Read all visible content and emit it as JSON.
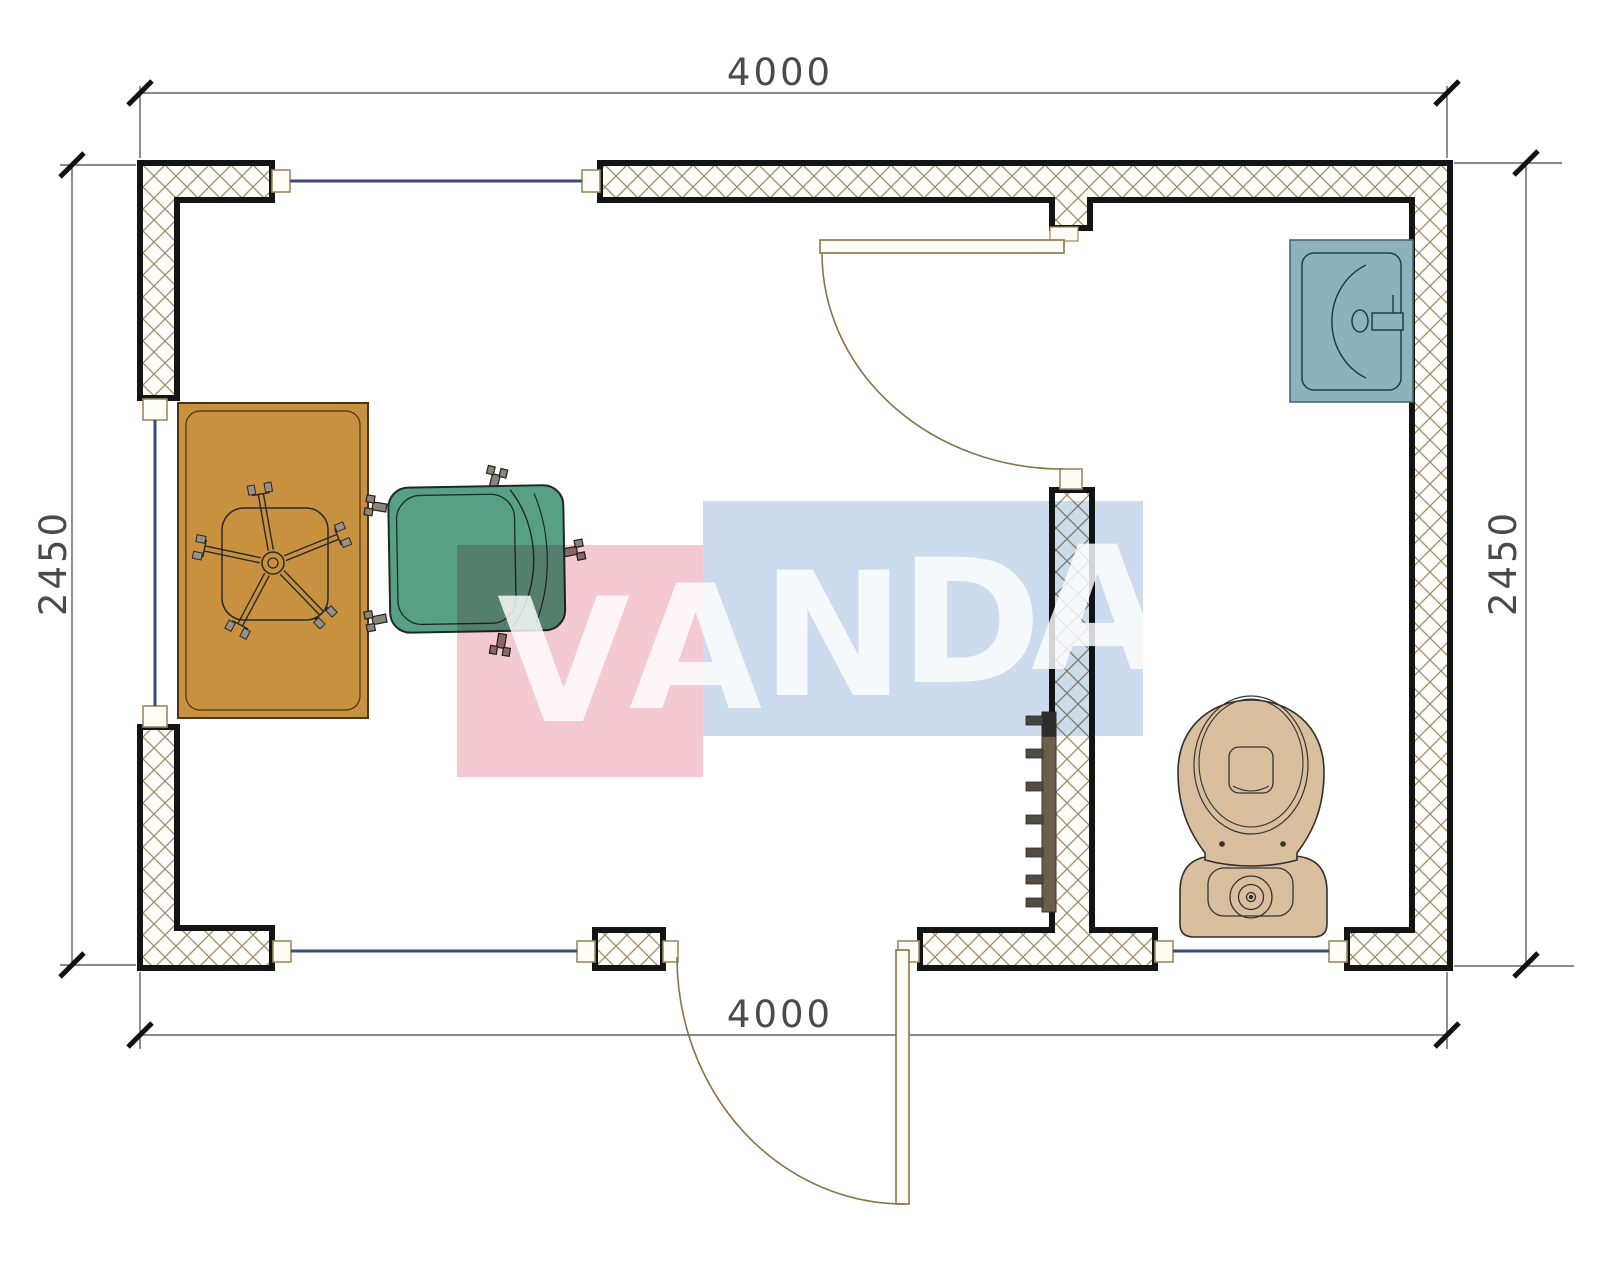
{
  "document": {
    "type": "architectural-floor-plan",
    "view": "top-down plan of portable cabin with office room and bathroom"
  },
  "dimensions": {
    "top": "4000",
    "bottom": "4000",
    "left": "2450",
    "right": "2450"
  },
  "watermark": {
    "text": "VANDA",
    "letters": [
      "V",
      "A",
      "N",
      "D",
      "A"
    ],
    "pink_block": "#f5c9d1",
    "blue_block": "#ccdcee",
    "letter_color": "#ffffff"
  },
  "plan": {
    "rooms": [
      {
        "name": "office",
        "items": [
          "desk",
          "desk-chair-base",
          "office-chair"
        ]
      },
      {
        "name": "bathroom",
        "items": [
          "sink",
          "toilet",
          "radiator"
        ]
      }
    ],
    "counts": {
      "windows": 4,
      "doors": 2,
      "wall-segments": 5
    },
    "colors": {
      "wall_hatch": "#9d8c68",
      "wall_outline": "#141414",
      "window_line": "#3e4a75",
      "door_swing": "#8a7348",
      "desk": "#c79140",
      "office_chair": "#57a085",
      "sink": "#8cb2bb",
      "toilet": "#d9bf9d",
      "radiator": "#6b5f4a",
      "dimension_text": "#4a4a4a"
    }
  }
}
